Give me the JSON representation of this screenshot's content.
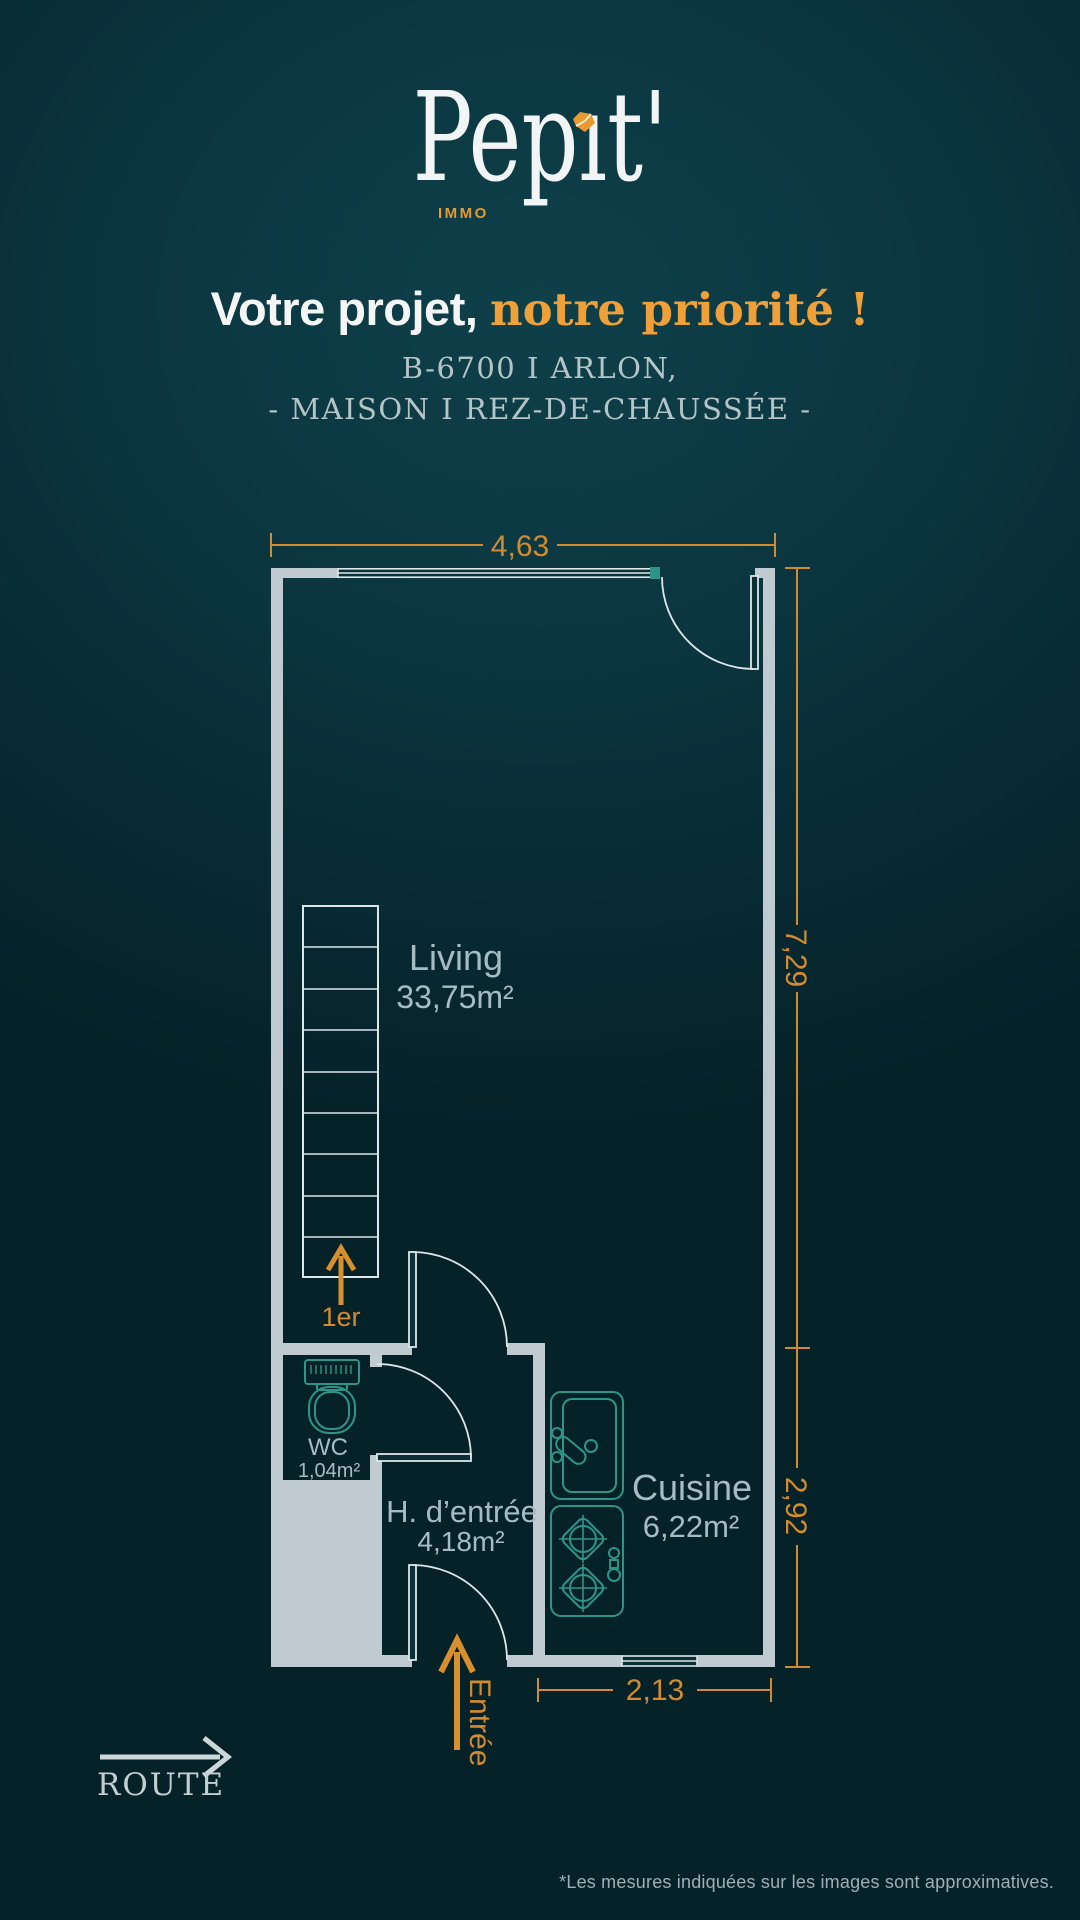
{
  "brand": {
    "wordmark": "Pepıt'",
    "sub": "IMMO"
  },
  "tagline": {
    "white": "Votre projet, ",
    "orange": "notre priorité !"
  },
  "location": {
    "line1": "B-6700 I ARLON,",
    "line2": "- MAISON I REZ-DE-CHAUSSÉE -"
  },
  "plan": {
    "dimensions": {
      "top": "4,63",
      "right_upper": "7,29",
      "right_lower": "2,92",
      "bottom": "2,13"
    },
    "rooms": [
      {
        "name": "Living",
        "area": "33,75m²"
      },
      {
        "name": "Cuisine",
        "area": "6,22m²"
      },
      {
        "name": "H. d’entrée",
        "area": "4,18m²"
      },
      {
        "name": "WC",
        "area": "1,04m²"
      }
    ],
    "stairs_label": "1er",
    "entrance_label": "Entrée",
    "road_label": "ROUTE"
  },
  "footnote": "*Les mesures indiquées sur les images sont approximatives.",
  "colors": {
    "background_dark": "#072830",
    "background_light": "#0e4049",
    "wall_gray": "#bfcbd1",
    "line_light": "#dde6e8",
    "accent_orange": "#d28b30",
    "tagline_orange": "#f0a038",
    "fixture_teal": "#2f9488",
    "label_gray": "#a6bcc2"
  }
}
